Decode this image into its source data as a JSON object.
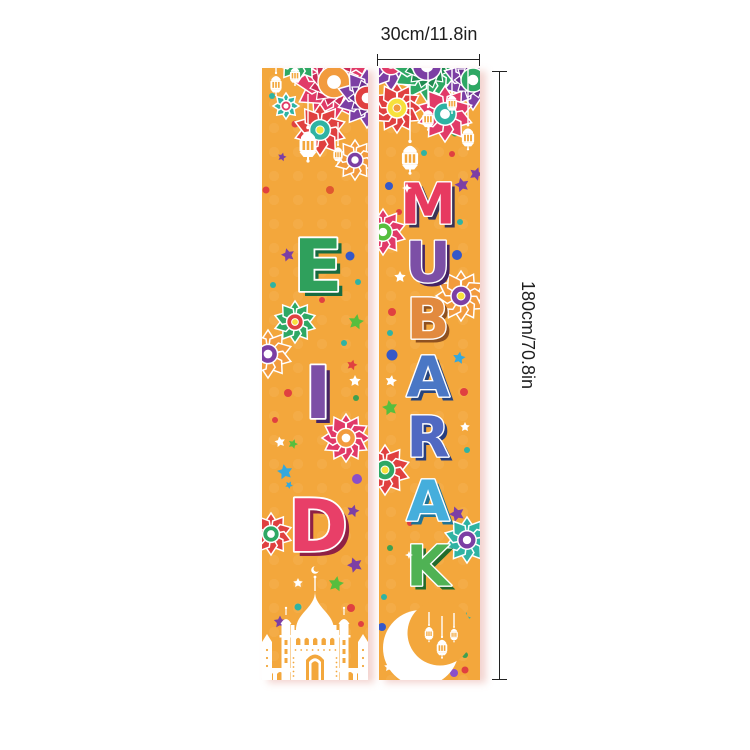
{
  "dimensions": {
    "width_label": "30cm/11.8in",
    "height_label": "180cm/70.8in"
  },
  "banner": {
    "bg": "#F3A73C",
    "outline": "#FFFFFF",
    "left": {
      "word": "EID",
      "font_size": 72,
      "shadow_offset": 5,
      "letters": [
        {
          "ch": "E",
          "x": 56,
          "y": 198,
          "fill": "#2FA05C",
          "shadow": "#176B40"
        },
        {
          "ch": "I",
          "x": 56,
          "y": 325,
          "fill": "#7C4FA6",
          "shadow": "#452465"
        },
        {
          "ch": "D",
          "x": 56,
          "y": 458,
          "fill": "#E83F68",
          "shadow": "#8F2145"
        }
      ],
      "decor": [
        {
          "t": "flower",
          "x": 72,
          "y": 14,
          "r": 40,
          "petals": 12,
          "c": "#E13A68",
          "ring": "#F29B3D",
          "center": "#FFFFFF",
          "l2": "#C92B57"
        },
        {
          "t": "flower",
          "x": 36,
          "y": -10,
          "r": 24,
          "petals": 10,
          "c": "#2EA864",
          "ring": "#7C3FA4"
        },
        {
          "t": "flower",
          "x": 105,
          "y": 30,
          "r": 30,
          "petals": 10,
          "c": "#7C3FA4",
          "ring": "#E04040",
          "l2": "#69308F"
        },
        {
          "t": "flower",
          "x": 58,
          "y": 62,
          "r": 26,
          "petals": 10,
          "c": "#E04040",
          "ring": "#2FB3A3",
          "center": "#F7E13C"
        },
        {
          "t": "flower",
          "x": 93,
          "y": 92,
          "r": 20,
          "petals": 10,
          "c": "#F29B3D",
          "ring": "#7C3FA4"
        },
        {
          "t": "flower",
          "x": 24,
          "y": 38,
          "r": 13,
          "petals": 8,
          "c": "#2FB3A3",
          "ring": "#E13A68"
        },
        {
          "t": "lantern",
          "x": 14,
          "y": 4,
          "s": 0.66,
          "sy": 0
        },
        {
          "t": "lantern",
          "x": 33,
          "y": -4,
          "s": 0.6,
          "sy": 0
        },
        {
          "t": "lantern",
          "x": 46,
          "y": 58,
          "s": 1.0,
          "sy": 26
        },
        {
          "t": "lantern",
          "x": 76,
          "y": 76,
          "s": 0.55,
          "sy": 54
        },
        {
          "t": "flower",
          "x": 33,
          "y": 254,
          "r": 21,
          "petals": 10,
          "c": "#2EA864",
          "ring": "#E04040",
          "center": "#F7E13C"
        },
        {
          "t": "flower",
          "x": 6,
          "y": 286,
          "r": 24,
          "petals": 10,
          "c": "#F29B3D",
          "ring": "#7C3FA4"
        },
        {
          "t": "flower",
          "x": 84,
          "y": 370,
          "r": 24,
          "petals": 12,
          "c": "#E13A68",
          "ring": "#F29B3D",
          "center": "#FFFFFF"
        },
        {
          "t": "flower",
          "x": 9,
          "y": 466,
          "r": 21,
          "petals": 10,
          "c": "#E04040",
          "ring": "#2EA864"
        },
        {
          "t": "mosque"
        },
        {
          "t": "dot",
          "x": 10,
          "y": 28,
          "r": 3,
          "c": "#2FB3A3"
        },
        {
          "t": "dot",
          "x": 33,
          "y": 56,
          "r": 3.5,
          "c": "#E04040"
        },
        {
          "t": "star",
          "x": 20,
          "y": 89,
          "r": 4.5,
          "c": "#7C3FA4",
          "rot": 15
        },
        {
          "t": "dot",
          "x": 4,
          "y": 122,
          "r": 3.5,
          "c": "#E04040"
        },
        {
          "t": "dot",
          "x": 68,
          "y": 122,
          "r": 4,
          "c": "#E0572F"
        },
        {
          "t": "star",
          "x": 26,
          "y": 187,
          "r": 7,
          "c": "#7C3FA4",
          "rot": -15
        },
        {
          "t": "dot",
          "x": 88,
          "y": 188,
          "r": 4.5,
          "c": "#3558C8"
        },
        {
          "t": "dot",
          "x": 96,
          "y": 214,
          "r": 3,
          "c": "#2FB3A3"
        },
        {
          "t": "dot",
          "x": 11,
          "y": 217,
          "r": 3,
          "c": "#2FB3A3"
        },
        {
          "t": "dot",
          "x": 60,
          "y": 232,
          "r": 3,
          "c": "#E04040"
        },
        {
          "t": "star",
          "x": 94,
          "y": 254,
          "r": 8,
          "c": "#57BE3E",
          "rot": 10
        },
        {
          "t": "dot",
          "x": 82,
          "y": 275,
          "r": 3,
          "c": "#2FB3A3"
        },
        {
          "t": "star",
          "x": 90,
          "y": 297,
          "r": 5.5,
          "c": "#E04040",
          "rot": 15
        },
        {
          "t": "star",
          "x": 93,
          "y": 313,
          "r": 6,
          "c": "#FFFFFF",
          "rot": 0
        },
        {
          "t": "dot",
          "x": 94,
          "y": 330,
          "r": 3,
          "c": "#3FA050"
        },
        {
          "t": "dot",
          "x": 26,
          "y": 325,
          "r": 4,
          "c": "#E04040"
        },
        {
          "t": "dot",
          "x": 13,
          "y": 352,
          "r": 3,
          "c": "#E04040"
        },
        {
          "t": "star",
          "x": 18,
          "y": 374,
          "r": 5.5,
          "c": "#FFFFFF",
          "rot": -10
        },
        {
          "t": "star",
          "x": 31,
          "y": 376,
          "r": 5,
          "c": "#57BE3E",
          "rot": 20
        },
        {
          "t": "star",
          "x": 23,
          "y": 404,
          "r": 8,
          "c": "#35A8DC",
          "rot": -10
        },
        {
          "t": "star",
          "x": 27,
          "y": 417,
          "r": 4,
          "c": "#35A8DC",
          "rot": 30
        },
        {
          "t": "dot",
          "x": 95,
          "y": 411,
          "r": 5,
          "c": "#8B4FC8"
        },
        {
          "t": "star",
          "x": 91,
          "y": 443,
          "r": 6.5,
          "c": "#7C3FA4",
          "rot": 15
        },
        {
          "t": "star",
          "x": 93,
          "y": 497,
          "r": 8,
          "c": "#7C3FA4",
          "rot": -20
        },
        {
          "t": "star",
          "x": 36,
          "y": 515,
          "r": 5,
          "c": "#FFFFFF",
          "rot": 0
        },
        {
          "t": "star",
          "x": 74,
          "y": 516,
          "r": 8,
          "c": "#57BE3E",
          "rot": 10
        },
        {
          "t": "dot",
          "x": 36,
          "y": 539,
          "r": 3.5,
          "c": "#2FB3A3"
        },
        {
          "t": "dot",
          "x": 89,
          "y": 540,
          "r": 4,
          "c": "#E04040"
        },
        {
          "t": "star",
          "x": 18,
          "y": 554,
          "r": 6.5,
          "c": "#7C3FA4",
          "rot": 0
        },
        {
          "t": "dot",
          "x": 99,
          "y": 556,
          "r": 3,
          "c": "#E04040"
        }
      ]
    },
    "right": {
      "word": "MUBARAK",
      "font_size": 56,
      "shadow_offset": 4,
      "letters": [
        {
          "ch": "M",
          "x": 49,
          "y": 137,
          "fill": "#E73A60",
          "shadow": "#3A3356"
        },
        {
          "ch": "U",
          "x": 49,
          "y": 195,
          "fill": "#7C4FA6",
          "shadow": "#452465"
        },
        {
          "ch": "B",
          "x": 49,
          "y": 252,
          "fill": "#E28A3E",
          "shadow": "#8F5120"
        },
        {
          "ch": "A",
          "x": 49,
          "y": 310,
          "fill": "#4A77C5",
          "shadow": "#27457E"
        },
        {
          "ch": "R",
          "x": 49,
          "y": 370,
          "fill": "#5069C2",
          "shadow": "#273D7E"
        },
        {
          "ch": "A",
          "x": 49,
          "y": 434,
          "fill": "#45AEDC",
          "shadow": "#1F7396"
        },
        {
          "ch": "K",
          "x": 49,
          "y": 499,
          "fill": "#4FB254",
          "shadow": "#236B2C"
        }
      ],
      "decor": [
        {
          "t": "flower",
          "x": 12,
          "y": -4,
          "r": 27,
          "petals": 10,
          "c": "#7C3FA4",
          "ring": "#E13A68"
        },
        {
          "t": "flower",
          "x": 48,
          "y": -2,
          "r": 36,
          "petals": 12,
          "c": "#2EA864",
          "ring": "#7C3FA4",
          "l2": "#1F8A50"
        },
        {
          "t": "flower",
          "x": 94,
          "y": 12,
          "r": 30,
          "petals": 10,
          "c": "#7C3FA4",
          "ring": "#2EA864",
          "l2": "#69308F"
        },
        {
          "t": "flower",
          "x": 18,
          "y": 40,
          "r": 25,
          "petals": 12,
          "c": "#E04040",
          "ring": "#F7E13C",
          "center": "#F29B3D"
        },
        {
          "t": "flower",
          "x": 66,
          "y": 46,
          "r": 28,
          "petals": 10,
          "c": "#E13A68",
          "ring": "#2FB3A3",
          "center": "#FFFFFF"
        },
        {
          "t": "lantern",
          "x": 73,
          "y": 24,
          "s": 0.6,
          "sy": 0
        },
        {
          "t": "lantern",
          "x": 49,
          "y": 38,
          "s": 0.68,
          "sy": 0
        },
        {
          "t": "lantern",
          "x": 89,
          "y": 56,
          "s": 0.72,
          "sy": 0
        },
        {
          "t": "lantern",
          "x": 31,
          "y": 72,
          "s": 0.95,
          "sy": 16
        },
        {
          "t": "flower",
          "x": 4,
          "y": 164,
          "r": 23,
          "petals": 10,
          "c": "#E13A68",
          "ring": "#57BE3E"
        },
        {
          "t": "flower",
          "x": 82,
          "y": 228,
          "r": 25,
          "petals": 12,
          "c": "#F29B3D",
          "ring": "#7C3FA4",
          "center": "#F7E13C"
        },
        {
          "t": "flower",
          "x": 6,
          "y": 402,
          "r": 25,
          "petals": 10,
          "c": "#E04040",
          "ring": "#2EA864",
          "center": "#F7E13C"
        },
        {
          "t": "flower",
          "x": 88,
          "y": 472,
          "r": 23,
          "petals": 10,
          "c": "#2FB3A3",
          "ring": "#7C3FA4"
        },
        {
          "t": "moon"
        },
        {
          "t": "dot",
          "x": 76,
          "y": 65,
          "r": 3.5,
          "c": "#3FA050"
        },
        {
          "t": "dot",
          "x": 45,
          "y": 85,
          "r": 3,
          "c": "#2FB3A3"
        },
        {
          "t": "dot",
          "x": 73,
          "y": 86,
          "r": 3,
          "c": "#E04040"
        },
        {
          "t": "star",
          "x": 97,
          "y": 106,
          "r": 7,
          "c": "#7C3FA4",
          "rot": 20
        },
        {
          "t": "dot",
          "x": 10,
          "y": 118,
          "r": 4,
          "c": "#3558C8"
        },
        {
          "t": "star",
          "x": 83,
          "y": 117,
          "r": 7.5,
          "c": "#7C3FA4",
          "rot": -15
        },
        {
          "t": "sparkle",
          "x": 28,
          "y": 120,
          "r": 5
        },
        {
          "t": "dot",
          "x": 20,
          "y": 144,
          "r": 3,
          "c": "#E04040"
        },
        {
          "t": "dot",
          "x": 81,
          "y": 154,
          "r": 3,
          "c": "#2FB3A3"
        },
        {
          "t": "dot",
          "x": 78,
          "y": 187,
          "r": 5,
          "c": "#3558C8"
        },
        {
          "t": "star",
          "x": 21,
          "y": 209,
          "r": 6,
          "c": "#FFFFFF",
          "rot": 0
        },
        {
          "t": "dot",
          "x": 13,
          "y": 244,
          "r": 4,
          "c": "#E04040"
        },
        {
          "t": "dot",
          "x": 11,
          "y": 265,
          "r": 3,
          "c": "#2FB3A3"
        },
        {
          "t": "dot",
          "x": 13,
          "y": 287,
          "r": 5.5,
          "c": "#3558C8"
        },
        {
          "t": "star",
          "x": 80,
          "y": 290,
          "r": 6.5,
          "c": "#35A8DC",
          "rot": 10
        },
        {
          "t": "star",
          "x": 12,
          "y": 313,
          "r": 6,
          "c": "#FFFFFF",
          "rot": 10
        },
        {
          "t": "dot",
          "x": 85,
          "y": 324,
          "r": 4,
          "c": "#E04040"
        },
        {
          "t": "star",
          "x": 11,
          "y": 340,
          "r": 8,
          "c": "#57BE3E",
          "rot": -10
        },
        {
          "t": "star",
          "x": 86,
          "y": 359,
          "r": 5,
          "c": "#FFFFFF",
          "rot": 0
        },
        {
          "t": "dot",
          "x": 88,
          "y": 382,
          "r": 3,
          "c": "#2FB3A3"
        },
        {
          "t": "star",
          "x": 78,
          "y": 446,
          "r": 8,
          "c": "#7C3FA4",
          "rot": -20
        },
        {
          "t": "dot",
          "x": 31,
          "y": 455,
          "r": 3,
          "c": "#E04040"
        },
        {
          "t": "dot",
          "x": 11,
          "y": 480,
          "r": 3,
          "c": "#3FA050"
        },
        {
          "t": "sparkle",
          "x": 30,
          "y": 487,
          "r": 4
        },
        {
          "t": "dot",
          "x": 5,
          "y": 529,
          "r": 3,
          "c": "#2FB3A3"
        },
        {
          "t": "star",
          "x": 86,
          "y": 550,
          "r": 6,
          "c": "#2FB3A3",
          "rot": 15
        },
        {
          "t": "dot",
          "x": 3,
          "y": 559,
          "r": 4,
          "c": "#3558C8"
        },
        {
          "t": "star",
          "x": 10,
          "y": 599,
          "r": 5,
          "c": "#FFFFFF",
          "rot": 0
        },
        {
          "t": "dot",
          "x": 75,
          "y": 605,
          "r": 4,
          "c": "#8B4FC8"
        },
        {
          "t": "dot",
          "x": 86,
          "y": 602,
          "r": 3.5,
          "c": "#E04040"
        },
        {
          "t": "dot",
          "x": 86,
          "y": 587,
          "r": 3,
          "c": "#3FA050"
        }
      ]
    }
  }
}
